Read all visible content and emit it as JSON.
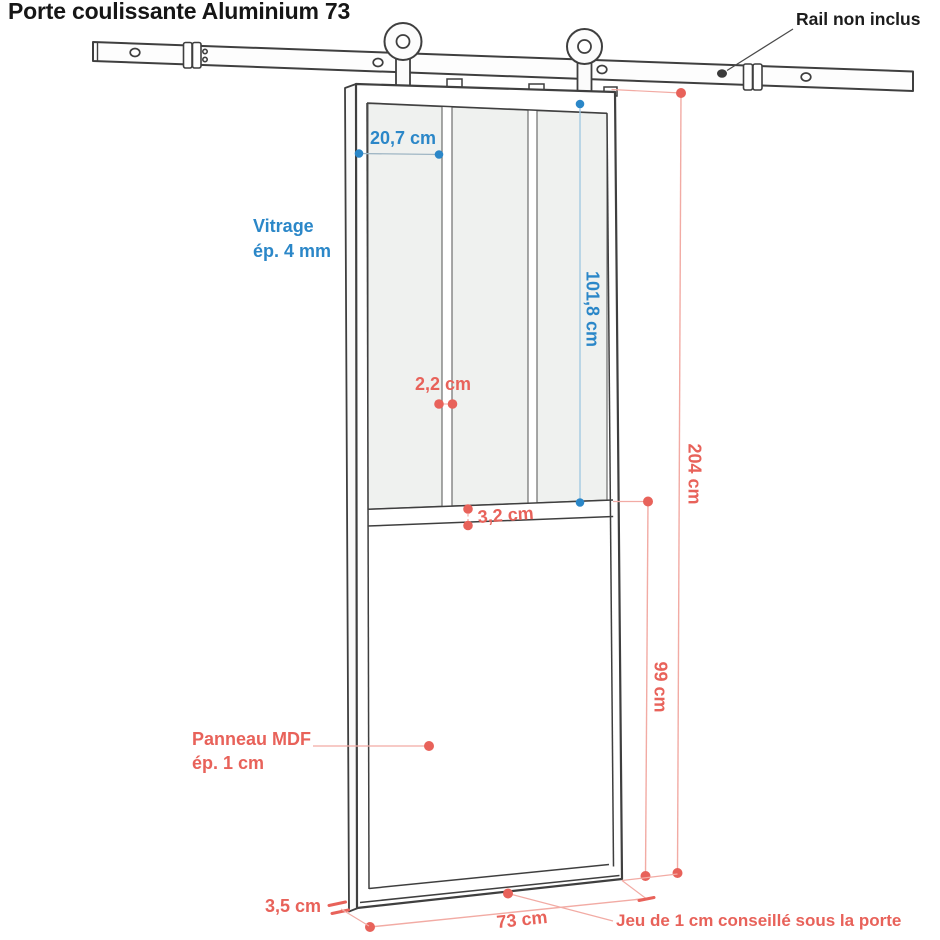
{
  "title": "Porte coulissante Aluminium 73",
  "annotations": {
    "rail_note": "Rail non inclus",
    "pane_width": "20,7 cm",
    "glazing_line1": "Vitrage",
    "glazing_line2": "ép. 4 mm",
    "glass_height": "101,8 cm",
    "muntin_width": "2,2 cm",
    "mid_rail_height": "3,2 cm",
    "door_height": "204 cm",
    "panel_height": "99 cm",
    "mdf_line1": "Panneau MDF",
    "mdf_line2": "ép. 1 cm",
    "frame_width": "3,5 cm",
    "door_width": "73 cm",
    "gap_note": "Jeu de 1 cm conseillé sous la porte"
  },
  "colors": {
    "dimension_blue": "#2b87c8",
    "dimension_blue_line": "#9ec7e2",
    "dimension_red": "#e8625a",
    "dimension_red_line": "#f2aba4",
    "outline": "#3f3f3f",
    "glass": "#eff1ef",
    "title_black": "#161616"
  }
}
